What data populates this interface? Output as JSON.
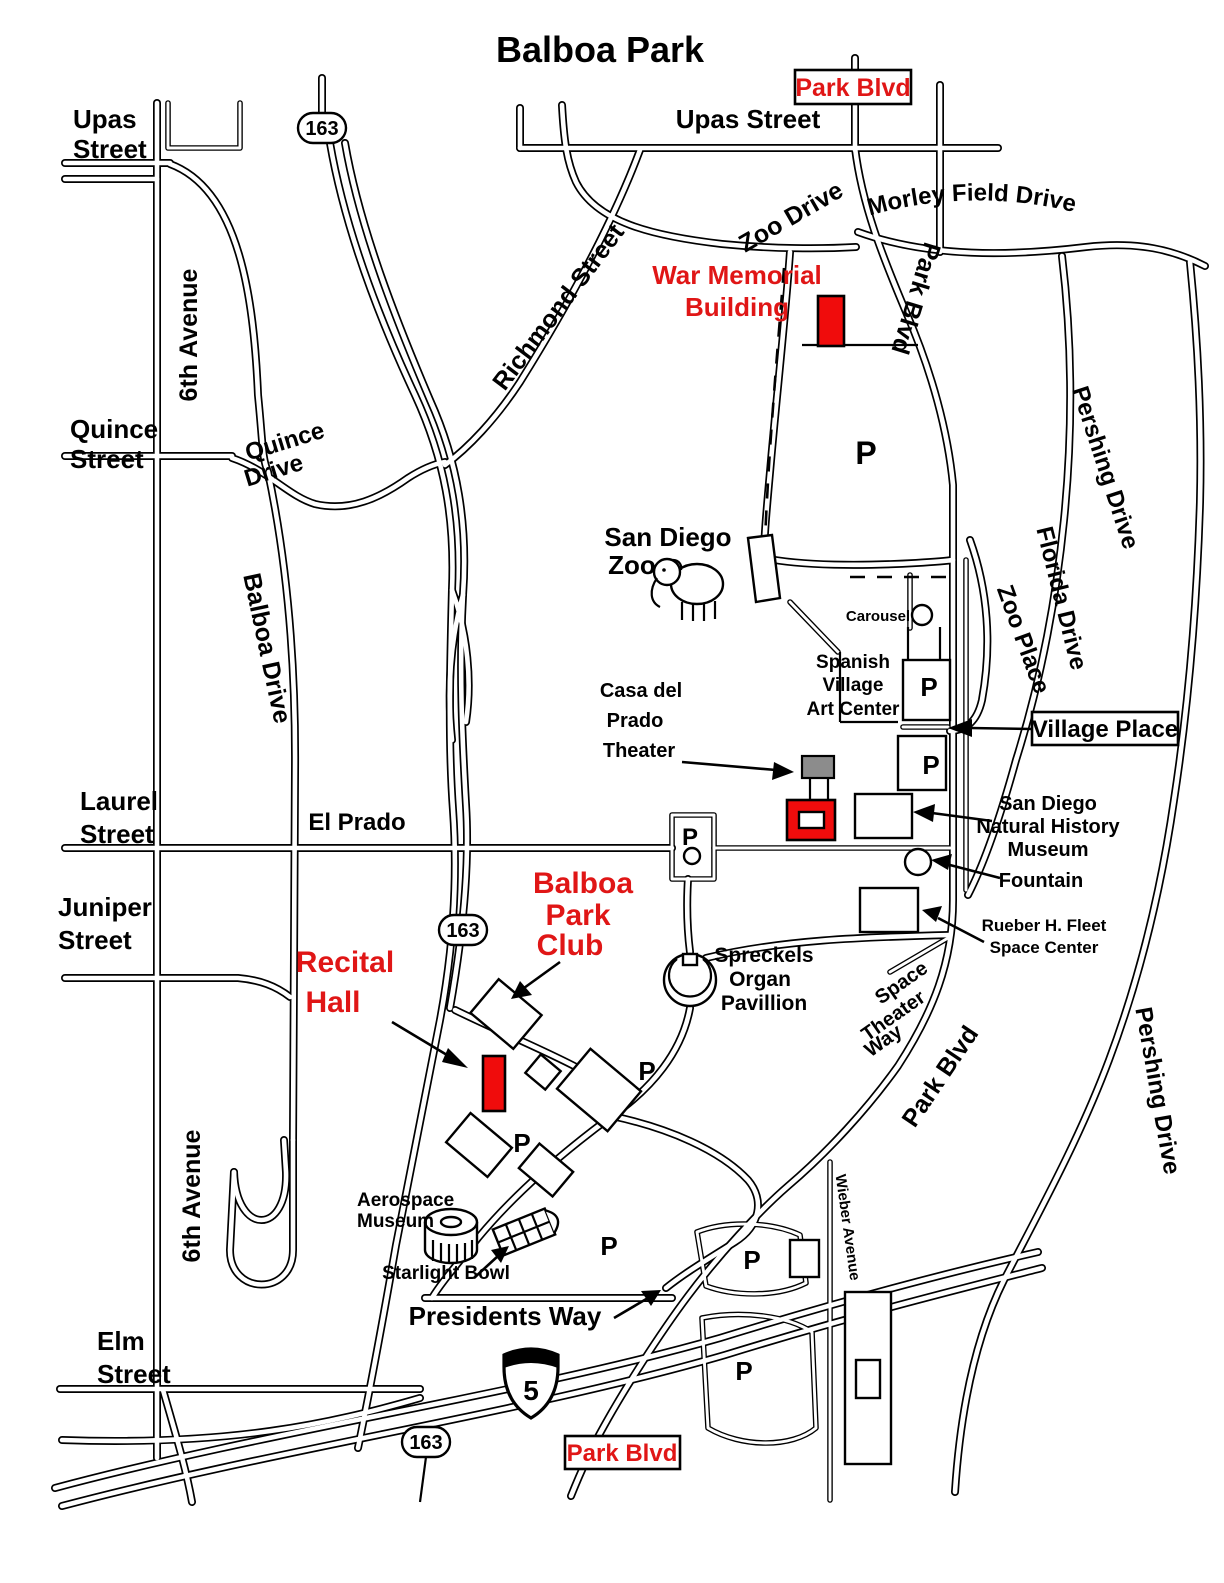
{
  "map": {
    "title": "Balboa Park",
    "parking_symbol": "P",
    "colors": {
      "highlight_red": "#e01616",
      "building_red": "#f00c0c",
      "building_gray": "#8c8c8c",
      "road_black": "#000000",
      "background": "#ffffff"
    },
    "highway_shields": {
      "route_163": "163",
      "interstate_5": "5"
    },
    "boxed_labels": {
      "park_blvd_top": "Park Blvd",
      "village_place": "Village Place",
      "park_blvd_bottom": "Park Blvd"
    },
    "street_labels": {
      "upas_street_left": {
        "lines": [
          "Upas",
          "Street"
        ]
      },
      "upas_street_right": "Upas Street",
      "morley_field_drive": "Morley Field Drive",
      "zoo_drive": "Zoo Drive",
      "richmond_street": "Richmond Street",
      "sixth_avenue_north": "6th Avenue",
      "sixth_avenue_south": "6th Avenue",
      "quince_street": {
        "lines": [
          "Quince",
          "Street"
        ]
      },
      "quince_drive": {
        "lines": [
          "Quince",
          "Drive"
        ]
      },
      "balboa_drive": "Balboa Drive",
      "pershing_drive_north": "Pershing Drive",
      "pershing_drive_south": "Pershing Drive",
      "florida_drive": "Florida Drive",
      "zoo_place": "Zoo Place",
      "park_blvd_upper": "Park Blvd",
      "park_blvd_lower": "Park Blvd",
      "laurel_street": {
        "lines": [
          "Laurel",
          "Street"
        ]
      },
      "el_prado": "El Prado",
      "juniper_street": {
        "lines": [
          "Juniper",
          "Street"
        ]
      },
      "space_theater_way": {
        "lines": [
          "Space",
          "Theater",
          "Way"
        ]
      },
      "presidents_way": "Presidents Way",
      "elm_street": {
        "lines": [
          "Elm",
          "Street"
        ]
      },
      "wieber_avenue": "Wieber Avenue"
    },
    "pois": {
      "war_memorial_building": {
        "lines": [
          "War Memorial",
          "Building"
        ]
      },
      "san_diego_zoo": {
        "lines": [
          "San Diego",
          "Zoo"
        ]
      },
      "carousel": "Carousel",
      "spanish_village_art_center": {
        "lines": [
          "Spanish",
          "Village",
          "Art Center"
        ]
      },
      "casa_del_prado_theater": {
        "lines": [
          "Casa del",
          "Prado",
          "Theater"
        ]
      },
      "natural_history_museum": {
        "lines": [
          "San Diego",
          "Natural History",
          "Museum"
        ]
      },
      "fountain": "Fountain",
      "fleet_space_center": {
        "lines": [
          "Rueber H. Fleet",
          "Space Center"
        ]
      },
      "balboa_park_club": {
        "lines": [
          "Balboa",
          "Park",
          "Club"
        ]
      },
      "recital_hall": {
        "lines": [
          "Recital",
          "Hall"
        ]
      },
      "spreckels_organ_pavillion": {
        "lines": [
          "Spreckels",
          "Organ",
          "Pavillion"
        ]
      },
      "aerospace_museum": {
        "lines": [
          "Aerospace",
          "Museum"
        ]
      },
      "starlight_bowl": "Starlight Bowl"
    }
  }
}
